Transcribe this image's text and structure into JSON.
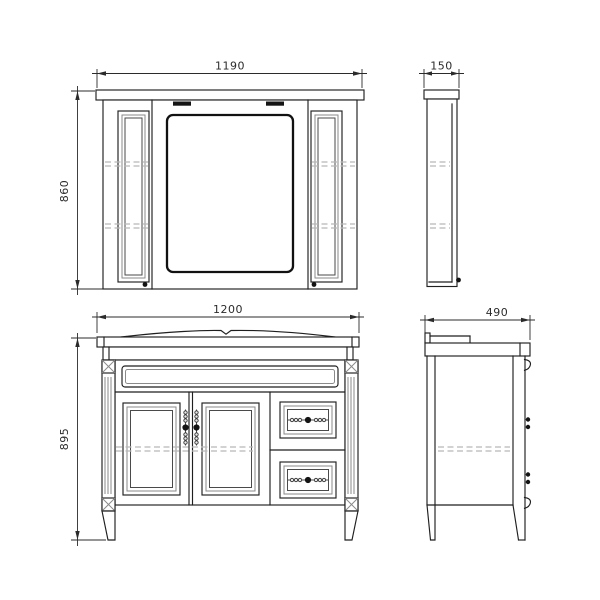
{
  "document": {
    "type": "furniture technical drawing",
    "subject": "bathroom vanity with mirror cabinet, front and side orthographic views"
  },
  "colors": {
    "background": "#ffffff",
    "line": "#1f1f1f",
    "dimension": "#2b2b2b",
    "shadow_band": "#9a9a9a",
    "dashed_shelf": "#b8b8b8",
    "inner_frame": "#8a8a8a"
  },
  "views": {
    "mirror_front": {
      "name": "mirror cabinet front view",
      "width_label": "1190",
      "height_label": "860"
    },
    "mirror_side": {
      "name": "mirror cabinet side view",
      "depth_label": "150"
    },
    "vanity_front": {
      "name": "vanity cabinet front view",
      "width_label": "1200",
      "height_label": "895"
    },
    "vanity_side": {
      "name": "vanity cabinet side view",
      "depth_label": "490"
    }
  }
}
